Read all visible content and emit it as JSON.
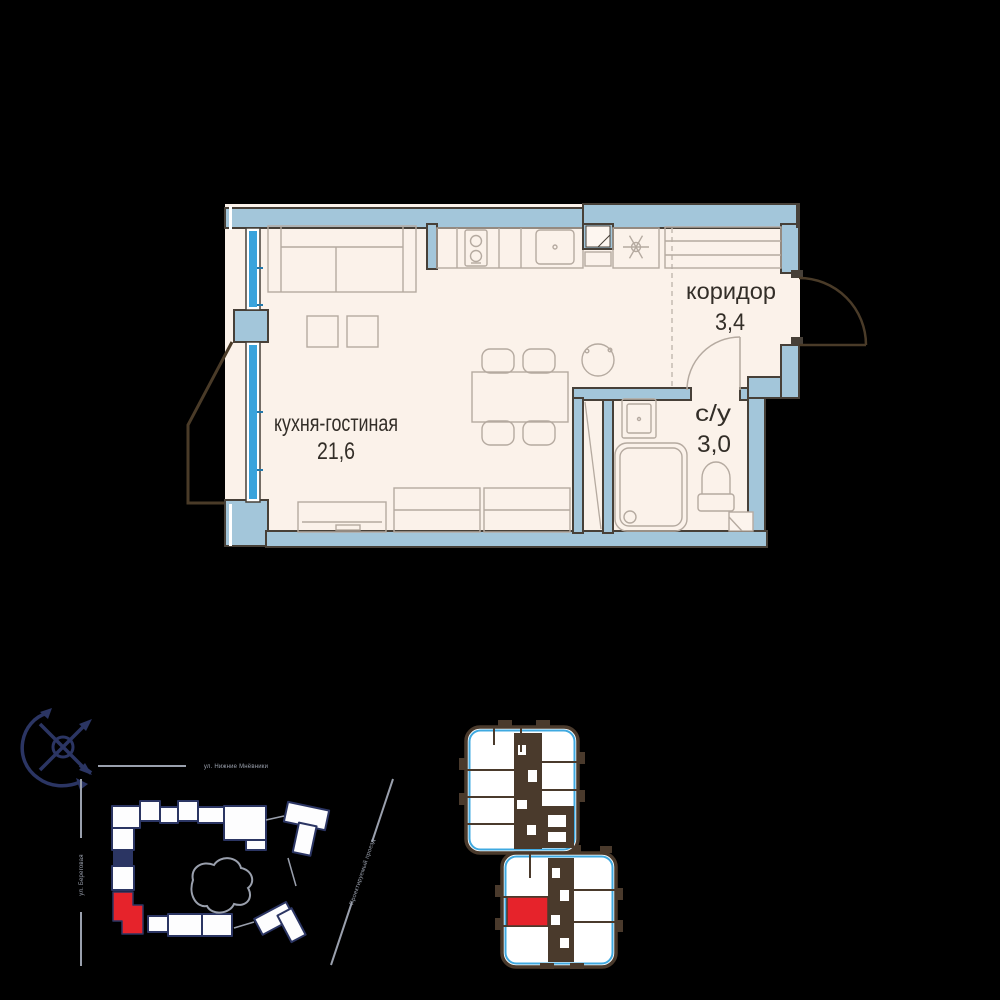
{
  "floor_plan": {
    "rooms": [
      {
        "name": "кухня-гостиная",
        "area": "21,6"
      },
      {
        "name": "коридор",
        "area": "3,4"
      },
      {
        "name": "с/у",
        "area": "3,0"
      }
    ]
  },
  "site_plan": {
    "street_top": "ул. Нижние Мнёвники",
    "street_left": "ул. Береговая",
    "street_right": "Проектируемый проезд"
  },
  "colors": {
    "background": "#000000",
    "wall_fill": "#a3c6da",
    "wall_outline": "#474038",
    "floor_fill": "#fbf2ea",
    "window_glass": "#39a3dc",
    "furniture_stroke": "#b5aaa0",
    "door_arc": "#4a3b28",
    "label_text": "#332e28",
    "site_navy": "#2b3563",
    "site_street_gray": "#9aa0ad",
    "highlight_red": "#e6232b",
    "keyplan_walls": "#4a3a2c",
    "keyplan_edge_blue": "#3fa9e0"
  }
}
